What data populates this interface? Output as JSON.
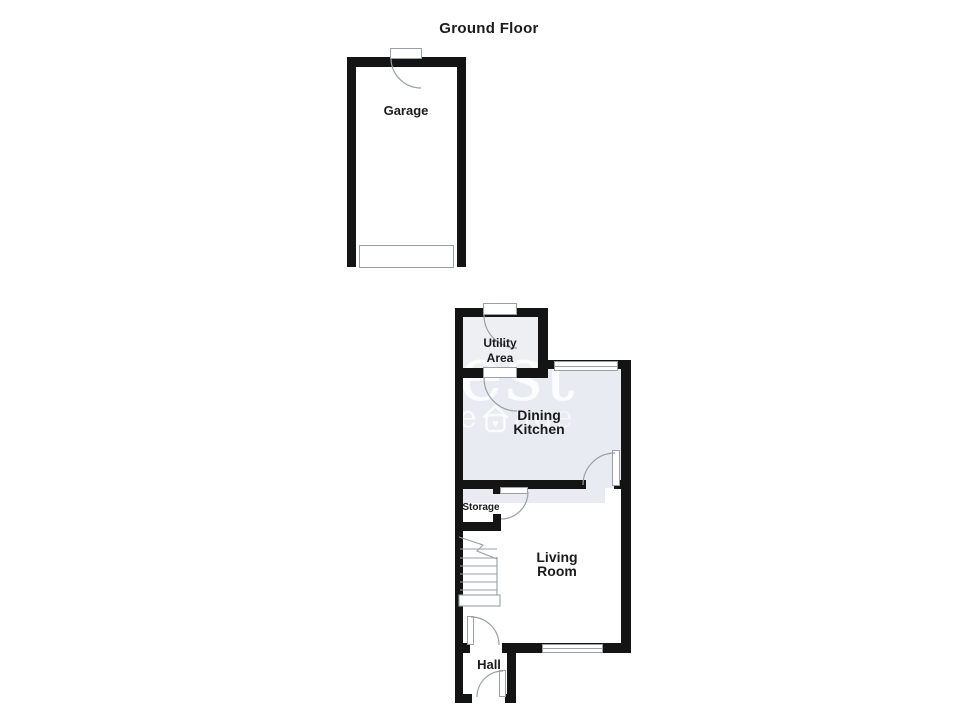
{
  "title": "Ground Floor",
  "rooms": {
    "garage": {
      "label": "Garage"
    },
    "utility": {
      "lines": [
        "Utility",
        "Area"
      ]
    },
    "dining": {
      "lines": [
        "Dining",
        "Kitchen"
      ]
    },
    "storage": {
      "label": "Storage"
    },
    "living": {
      "lines": [
        "Living",
        "Room"
      ]
    },
    "hall": {
      "label": "Hall"
    }
  },
  "watermark": {
    "large": "est",
    "left": "e",
    "right": "age",
    "icon": "house-with-heart"
  },
  "colors": {
    "background": "#ffffff",
    "wall": "#141414",
    "dining-fill": "#e8ebf2",
    "utility-fill": "#eeeff3",
    "feature-outline": "#9aa0a6",
    "label": "#1b1b1b",
    "watermark": "#ffffff"
  }
}
